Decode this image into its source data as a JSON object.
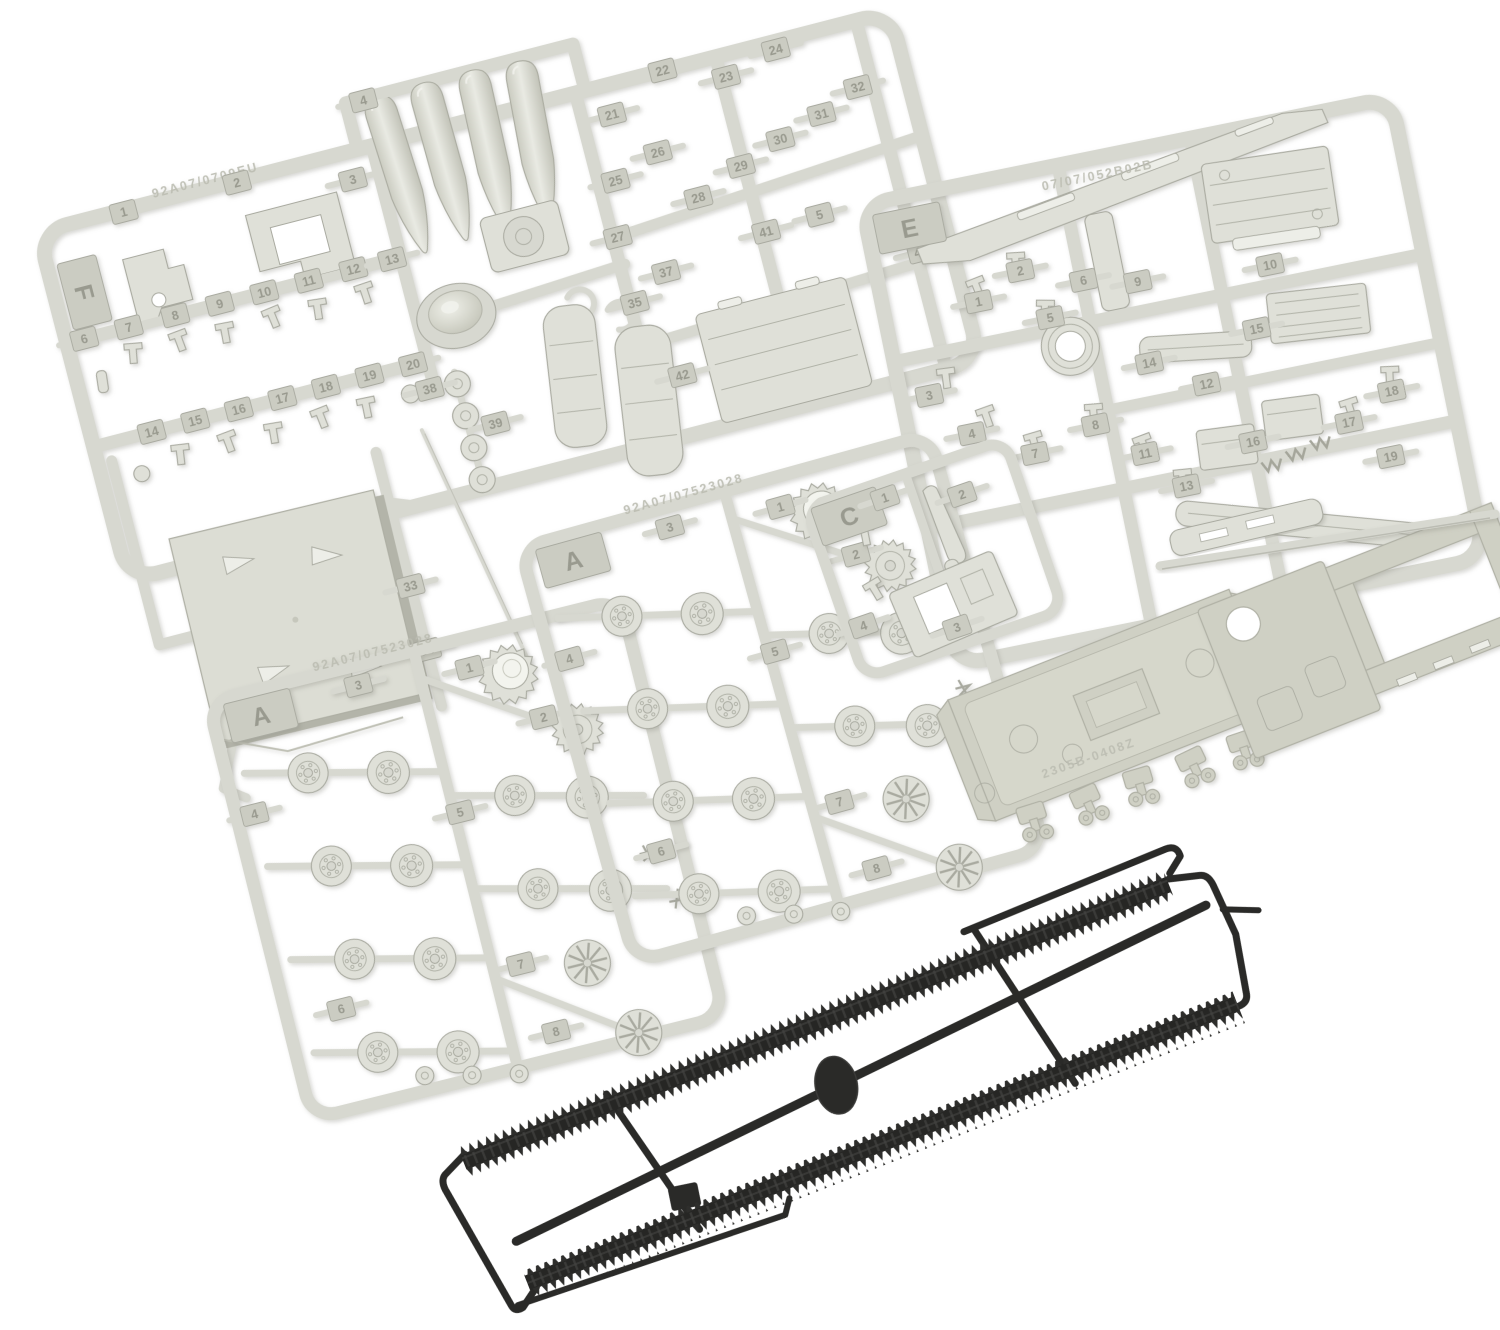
{
  "photo": {
    "subject": "Plastic scale model tank kit contents: five light-gray styrene part sprues, loose hull parts and one black flexible track runner on a white background",
    "background_color": "#ffffff"
  },
  "colors": {
    "background": "#ffffff",
    "sprue": "#d7d8d0",
    "sprue_shadow": "#a9aaa0",
    "part_face": "#dfe0d8",
    "part_light": "#edeee8",
    "hull": "#cfd0c4",
    "hull_dark": "#b0b1a5",
    "tag_fill": "#cbccc2",
    "tag_text": "#999a8f",
    "emboss": "#bcbdb2",
    "track_black": "#2a2a28",
    "track_dark": "#1d1d1c",
    "track_mid": "#3a3a38"
  },
  "sprues": {
    "f": {
      "label": "F",
      "embossed": "92A07/0709EU",
      "parts": [
        "1",
        "2",
        "3",
        "4",
        "5",
        "6",
        "7",
        "8",
        "9",
        "10",
        "11",
        "12",
        "13",
        "14",
        "15",
        "16",
        "17",
        "18",
        "19",
        "20",
        "21",
        "22",
        "23",
        "24",
        "25",
        "26",
        "27",
        "28",
        "29",
        "30",
        "31",
        "32",
        "35",
        "37",
        "38",
        "39",
        "40",
        "41",
        "42"
      ]
    },
    "e": {
      "label": "E",
      "embossed": "07/07/052B02B",
      "parts": [
        "1",
        "2",
        "3",
        "4",
        "5",
        "6",
        "7",
        "8",
        "9",
        "10",
        "11",
        "12",
        "13",
        "14",
        "15",
        "16",
        "17",
        "18",
        "19"
      ]
    },
    "a1": {
      "label": "A",
      "embossed": "92A07/07523028",
      "parts": [
        "1",
        "2",
        "3",
        "4",
        "5",
        "6",
        "7",
        "8"
      ]
    },
    "a2": {
      "label": "A",
      "embossed": "92A07/07523028",
      "parts": [
        "1",
        "2",
        "3",
        "4",
        "5",
        "6",
        "7",
        "8"
      ]
    },
    "c": {
      "label": "C",
      "parts": [
        "1",
        "2",
        "3",
        "4"
      ]
    }
  },
  "roof_panel": {
    "parts": [
      "33",
      "34"
    ]
  },
  "loose_parts": {
    "roof_panel": "square hull roof panel",
    "lower_hull": "lower hull tub with suspension bogies",
    "upper_hull": "upper hull shell with open fighting-compartment ring",
    "fender_strip": "fender strip",
    "barrel_rod": "long barrel rod"
  },
  "track_runner": {
    "color_name": "black",
    "track_count": 2
  }
}
